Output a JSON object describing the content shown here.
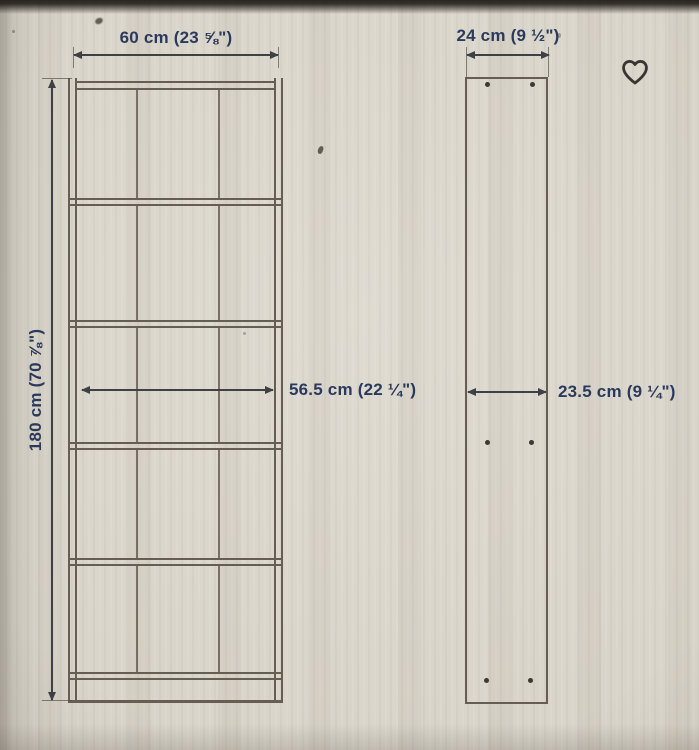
{
  "colors": {
    "background": "#d6d1c6",
    "dimension_text": "#2b3a5c",
    "drawing_line": "#675e53",
    "arrow": "#3f4046",
    "heart_icon": "#3a3531"
  },
  "front_view": {
    "description": "bookcase front elevation with five shelf compartments",
    "width_label": "60 cm (23 ⅝\")",
    "height_label": "180 cm (70 ⅞\")",
    "interior_width_label": "56.5 cm (22 ¼\")",
    "shelf_rows": 5
  },
  "side_view": {
    "description": "bookcase side panel with drill holes",
    "depth_label": "24 cm (9 ½\")",
    "interior_depth_label": "23.5 cm (9 ¼\")"
  },
  "icons": {
    "favorite": "heart-outline"
  }
}
